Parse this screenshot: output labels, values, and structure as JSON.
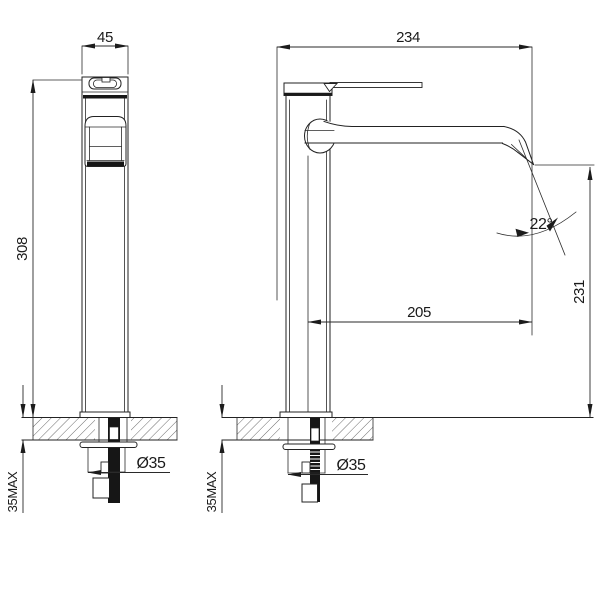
{
  "drawing": {
    "background": "#ffffff",
    "line_color": "#222222",
    "dim": {
      "front_width": "45",
      "front_height": "308",
      "front_deck_max": "35MAX",
      "front_hole_dia": "Ø35",
      "side_depth": "234",
      "side_reach": "205",
      "side_outlet_height": "231",
      "side_outlet_angle": "22°",
      "side_deck_max": "35MAX",
      "side_hole_dia": "Ø35"
    }
  }
}
